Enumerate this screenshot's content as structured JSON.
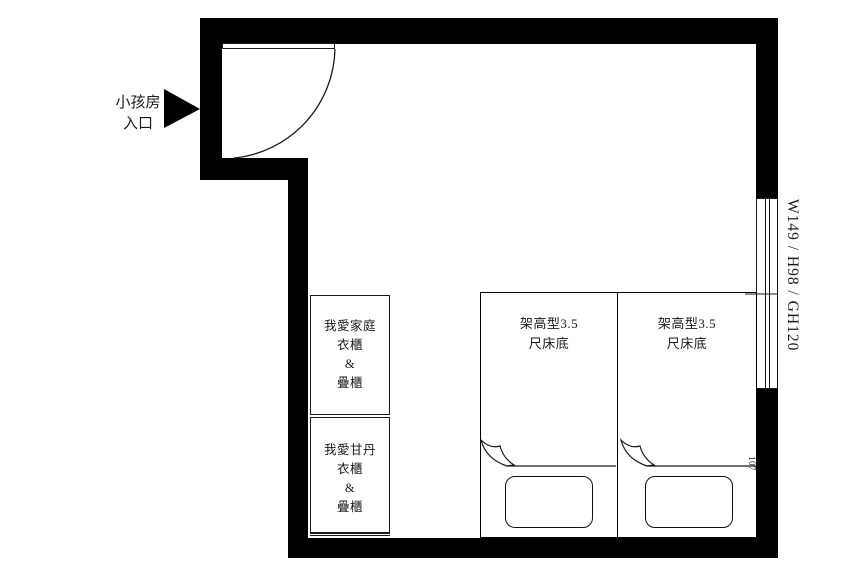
{
  "floorplan": {
    "entrance": {
      "label": [
        "小孩房",
        "入口"
      ]
    },
    "window": {
      "label": "W149 / H98 / GH120"
    },
    "wall_note": "107",
    "cabinets": [
      {
        "lines": [
          "我愛家庭",
          "衣櫃",
          "&",
          "疊櫃"
        ]
      },
      {
        "lines": [
          "我愛甘丹",
          "衣櫃",
          "&",
          "疊櫃"
        ]
      }
    ],
    "beds": [
      {
        "lines": [
          "架高型3.5",
          "尺床底"
        ]
      },
      {
        "lines": [
          "架高型3.5",
          "尺床底"
        ]
      }
    ],
    "colors": {
      "wall": "#000000",
      "line": "#1a1a1a",
      "background": "#ffffff"
    }
  }
}
